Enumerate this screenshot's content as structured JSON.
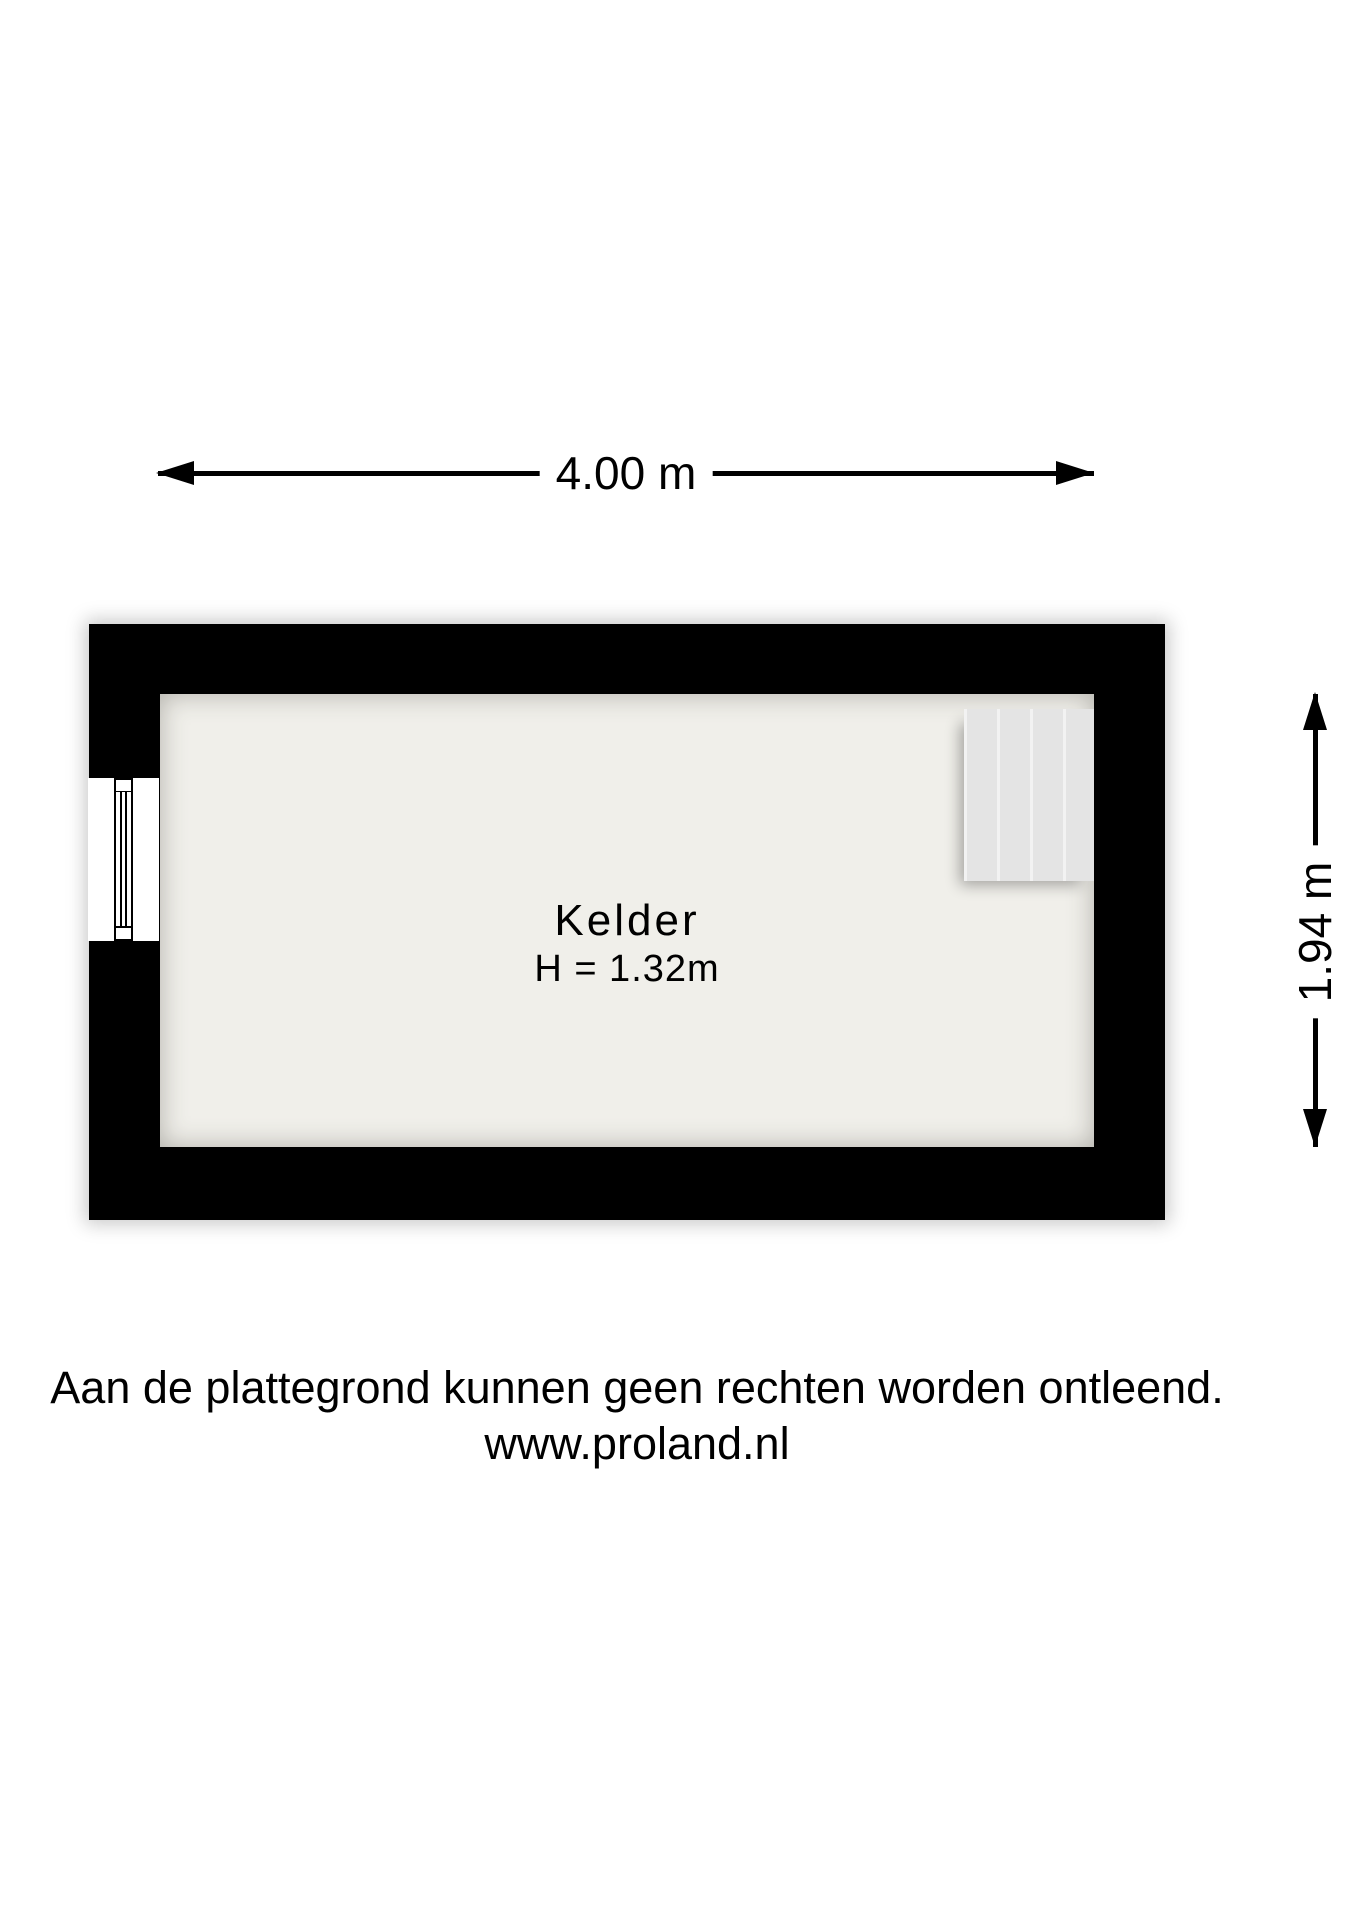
{
  "dimensions": {
    "top": {
      "label": "4.00 m"
    },
    "right": {
      "label": "1.94 m"
    }
  },
  "room": {
    "name": "Kelder",
    "height_label": "H = 1.32m"
  },
  "footer": {
    "line1": "Aan de plattegrond kunnen geen rechten worden ontleend.",
    "line2": "www.proland.nl"
  },
  "icons": {
    "dimension_arrowheads": [
      "arrowhead-left-icon",
      "arrowhead-right-icon",
      "arrowhead-up-icon",
      "arrowhead-down-icon"
    ]
  },
  "colors": {
    "page": "#ffffff",
    "wall": "#000000",
    "floor": "#f0efea",
    "stairs": "#e4e4e4",
    "text": "#000000"
  }
}
